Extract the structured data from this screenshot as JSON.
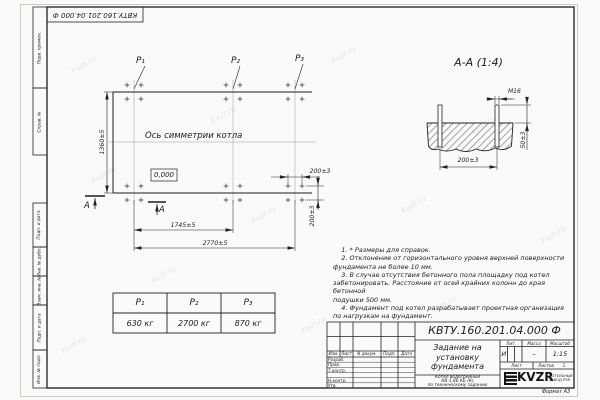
{
  "corner_stamp": "КВТУ.160.201.04.000 Ф",
  "watermark": "kvzr.ru",
  "margin": {
    "top": [
      "Перв. примен.",
      "Справ. №"
    ],
    "bottom": [
      "Подп. и дата",
      "Инв. № дубл.",
      "Взам. инв. №",
      "Подп. и дата",
      "Инв. № подл."
    ]
  },
  "plan": {
    "p1": "Р₁",
    "p2": "Р₂",
    "p3": "Р₃",
    "axis_label": "Ось симметрии котла",
    "level": "0,000",
    "section_letter": "А",
    "dim_height": "1360±5",
    "dim_mid": "1745±5",
    "dim_full": "2770±5",
    "dim_bolt_h": "200±3",
    "dim_bolt_v": "200±3"
  },
  "section": {
    "title": "А-А (1:4)",
    "thread": "М16",
    "dim_width": "200±3",
    "dim_height": "50±3"
  },
  "notes_text": "    1. * Размеры для справок.\n    2. Отклонение от горизонтального уровня верхней поверхности\nфундамента не более 10 мм.\n    3. В случае отсутствия бетонного пола площадку под котел\nзабетонировать. Расстояние от осей крайних колонн до края бетонной\nподушки 500 мм.\n    4. Фундамент под котел разрабатывает проектная организация\nпо нагрузкам на фундамент.",
  "table": {
    "headers": [
      "Р₁",
      "Р₂",
      "Р₃"
    ],
    "values": [
      "630 кг",
      "2700 кг",
      "870 кг"
    ]
  },
  "title_block": {
    "designation": "КВТУ.160.201.04.000 Ф",
    "rev_headers": [
      "Изм.",
      "Лист",
      "N докум.",
      "Подп.",
      "Дата"
    ],
    "roles": [
      "Разраб.",
      "Пров.",
      "Т.контр.",
      "Н.контр.",
      "Утв."
    ],
    "title": "Задание на установку фундамента",
    "product_line1": "Котел водогрейный",
    "product_line2": "КВ-1,86 КБ (К)",
    "product_line3": "по техническому заданию",
    "lit_label": "Лит.",
    "mass_label": "Масса",
    "scale_label": "Масштаб",
    "lit_value": "И",
    "mass_value": "–",
    "scale_value": "1:15",
    "sheet_label": "Лист",
    "sheets_label": "Листов",
    "sheets_value": "1",
    "logo": "KVZR",
    "logo_caption1": "КОТЕЛЬНЫЙ",
    "logo_caption2": "ЗАВОД РЭП",
    "format": "Формат А3"
  }
}
